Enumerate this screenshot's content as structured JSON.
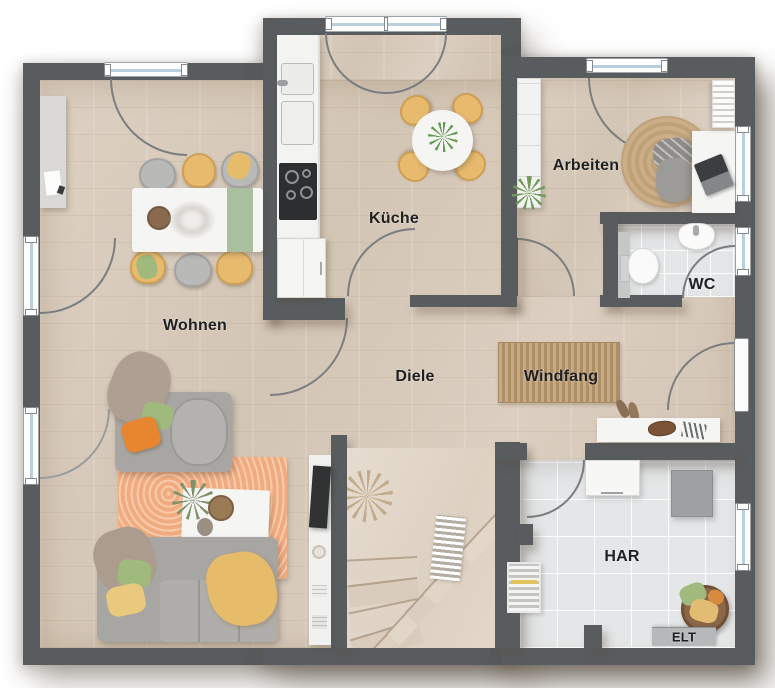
{
  "floorplan": {
    "rooms": [
      {
        "id": "wohnen",
        "label": "Wohnen"
      },
      {
        "id": "kueche",
        "label": "Küche"
      },
      {
        "id": "arbeiten",
        "label": "Arbeiten"
      },
      {
        "id": "wc",
        "label": "WC"
      },
      {
        "id": "diele",
        "label": "Diele"
      },
      {
        "id": "windfang",
        "label": "Windfang"
      },
      {
        "id": "har",
        "label": "HAR"
      },
      {
        "id": "elt",
        "label": "ELT"
      }
    ],
    "colors": {
      "wall": "#585c5f",
      "wood": "#d8cbbc",
      "tile": "#e4e6e7",
      "window_glass": "#b9cfdd",
      "chair_yellow": "#e7ba6e",
      "sofa_gray": "#a8a6a2",
      "rug_orange": "#f0ab80",
      "rug_jute": "#c9ad85",
      "mat_brown": "#b7996f",
      "pillow_orange": "#e8862f",
      "pillow_green": "#9fba7c",
      "throw_yellow": "#e6bb6a"
    }
  }
}
